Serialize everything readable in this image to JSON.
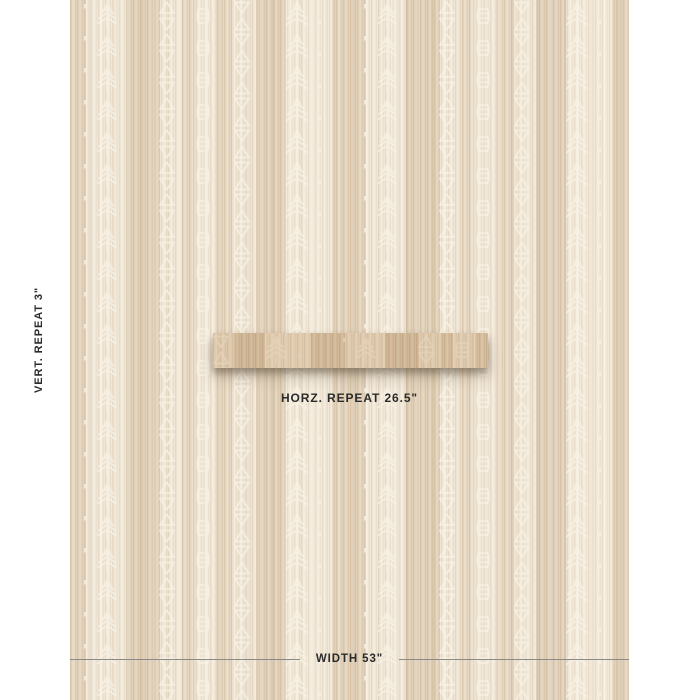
{
  "annotations": {
    "vertical_repeat_label": "VERT. REPEAT 3\"",
    "horizontal_repeat_label": "HORZ. REPEAT 26.5\"",
    "width_label": "WIDTH 53\""
  },
  "swatch": {
    "motif_columns": [
      "dots",
      "sprig",
      "triangles",
      "ladder",
      "triangles",
      "sprig",
      "dots"
    ]
  },
  "colors": {
    "page-bg": "#ffffff",
    "fabric-base": "#e9ddc9",
    "fabric-stripe-light": "#f0e6d6",
    "fabric-stripe-dark": "#ddccb1",
    "motif": "#f8f2e5",
    "strip-tint": "#c6a070",
    "label-text": "#2b2b2b",
    "rule-line": "#8a8a8a"
  }
}
